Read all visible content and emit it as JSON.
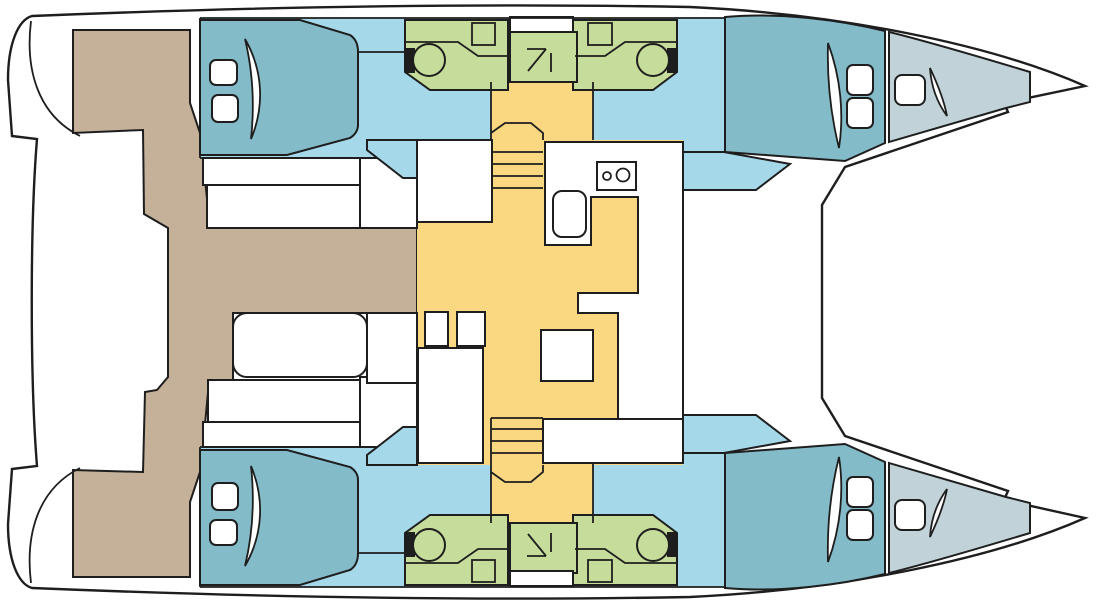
{
  "page": {
    "title": "Catamaran yacht deck layout plan (top view, bow to the right)"
  },
  "colors": {
    "line": "#1e1e1e",
    "white": "#ffffff",
    "tan": "#c5b199",
    "teal": "#83bbc8",
    "corridor": "#a5d9e9",
    "forepeak": "#c1d3d9",
    "bath": "#c5dc9a",
    "salon": "#fad781"
  },
  "diagram": {
    "type": "boat-floor-plan",
    "vessel": "catamaran",
    "areas": [
      "aft-cockpit",
      "cockpit-table",
      "cockpit-benches",
      "salon",
      "galley",
      "galley-stove",
      "galley-sink",
      "salon-table",
      "port-stairs",
      "starboard-stairs",
      "port-aft-cabin",
      "port-head",
      "port-shower",
      "port-forward-cabin",
      "port-forepeak",
      "starboard-aft-cabin",
      "starboard-head",
      "starboard-shower",
      "starboard-forward-cabin",
      "starboard-forepeak",
      "foredeck",
      "transom-steps"
    ]
  }
}
